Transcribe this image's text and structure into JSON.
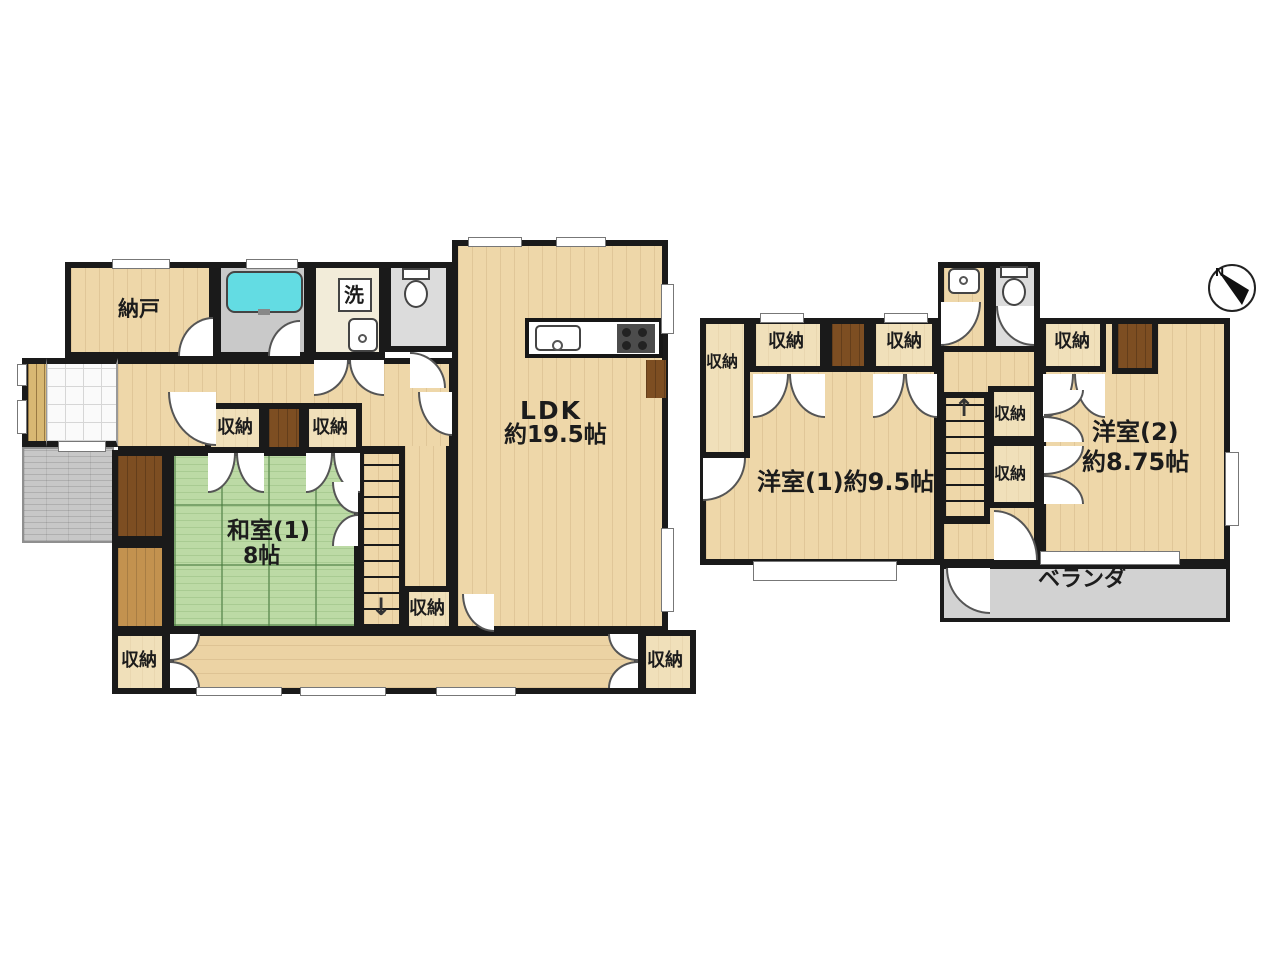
{
  "floor1": {
    "nando_label": "納戸",
    "laundry_label": "洗",
    "ldk_label": "LDK",
    "ldk_size": "約19.5帖",
    "washitsu_label": "和室(1)",
    "washitsu_size": "8帖",
    "stairs_down_arrow": "↓"
  },
  "floor2": {
    "room1_label": "洋室(1)約9.5帖",
    "room2_label": "洋室(2)",
    "room2_size": "約8.75帖",
    "veranda_label": "ベランダ",
    "stairs_up_arrow": "↑"
  },
  "shared": {
    "closet_label": "収納"
  },
  "compass": {
    "north_label": "N"
  },
  "colors": {
    "wall": "#1a1a1a",
    "wood_floor": "#eed7a9",
    "tatami_green": "#bcdaa5",
    "bathtub_cyan": "#63dce3",
    "dark_wood": "#7d4e22",
    "mid_wood": "#c3924f",
    "veranda_gray": "#d2d2d2"
  }
}
